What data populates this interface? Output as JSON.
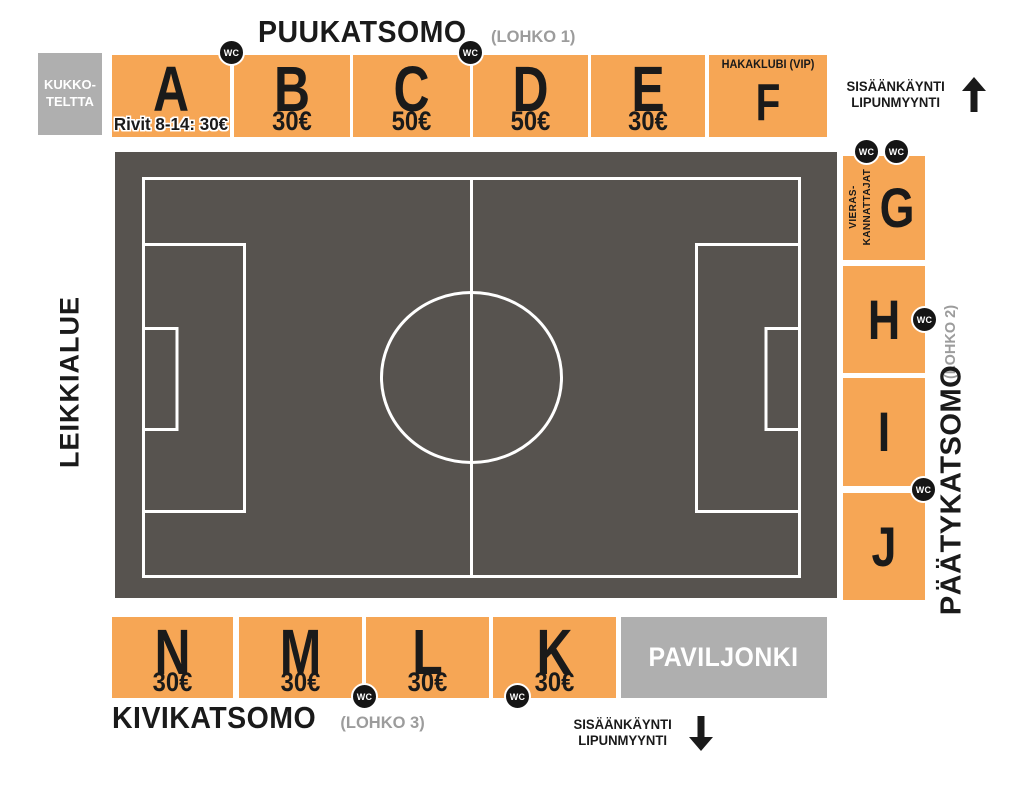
{
  "colors": {
    "section_orange": "#F6A655",
    "area_gray": "#AFAFAF",
    "pitch_gray": "#57534F",
    "text_black": "#1A1A1A",
    "muted_gray": "#9C9C9C",
    "wc_black": "#151515",
    "line_white": "#FFFFFF"
  },
  "stands": {
    "top": {
      "name": "PUUKATSOMO",
      "block": "(LOHKO 1)"
    },
    "right": {
      "name": "PÄÄTYKATSOMO",
      "block": "(LOHKO 2)"
    },
    "bottom": {
      "name": "KIVIKATSOMO",
      "block": "(LOHKO 3)"
    }
  },
  "sections": {
    "top_row": [
      {
        "id": "A",
        "letter": "A",
        "price": "Rivit 8-14: 30€"
      },
      {
        "id": "B",
        "letter": "B",
        "price": "30€"
      },
      {
        "id": "C",
        "letter": "C",
        "price": "50€"
      },
      {
        "id": "D",
        "letter": "D",
        "price": "50€"
      },
      {
        "id": "E",
        "letter": "E",
        "price": "30€"
      },
      {
        "id": "F",
        "letter": "F",
        "note": "HAKAKLUBI (VIP)"
      }
    ],
    "right_column": [
      {
        "id": "G",
        "letter": "G",
        "note_line1": "VIERAS-",
        "note_line2": "KANNATTAJAT"
      },
      {
        "id": "H",
        "letter": "H"
      },
      {
        "id": "I",
        "letter": "I"
      },
      {
        "id": "J",
        "letter": "J"
      }
    ],
    "bottom_row": [
      {
        "id": "N",
        "letter": "N",
        "price": "30€"
      },
      {
        "id": "M",
        "letter": "M",
        "price": "30€"
      },
      {
        "id": "L",
        "letter": "L",
        "price": "30€"
      },
      {
        "id": "K",
        "letter": "K",
        "price": "30€"
      }
    ]
  },
  "areas": {
    "kukko_teltta": {
      "line1": "KUKKO-",
      "line2": "TELTTA"
    },
    "leikkialue": "LEIKKIALUE",
    "paviljonki": "PAVILJONKI"
  },
  "entrances": {
    "top": {
      "line1": "SISÄÄNKÄYNTI",
      "line2": "LIPUNMYYNTI",
      "direction": "up"
    },
    "bottom": {
      "line1": "SISÄÄNKÄYNTI",
      "line2": "LIPUNMYYNTI",
      "direction": "down"
    }
  },
  "icons": {
    "wc_label": "WC",
    "up_arrow": "arrow-up-icon",
    "down_arrow": "arrow-down-icon"
  }
}
